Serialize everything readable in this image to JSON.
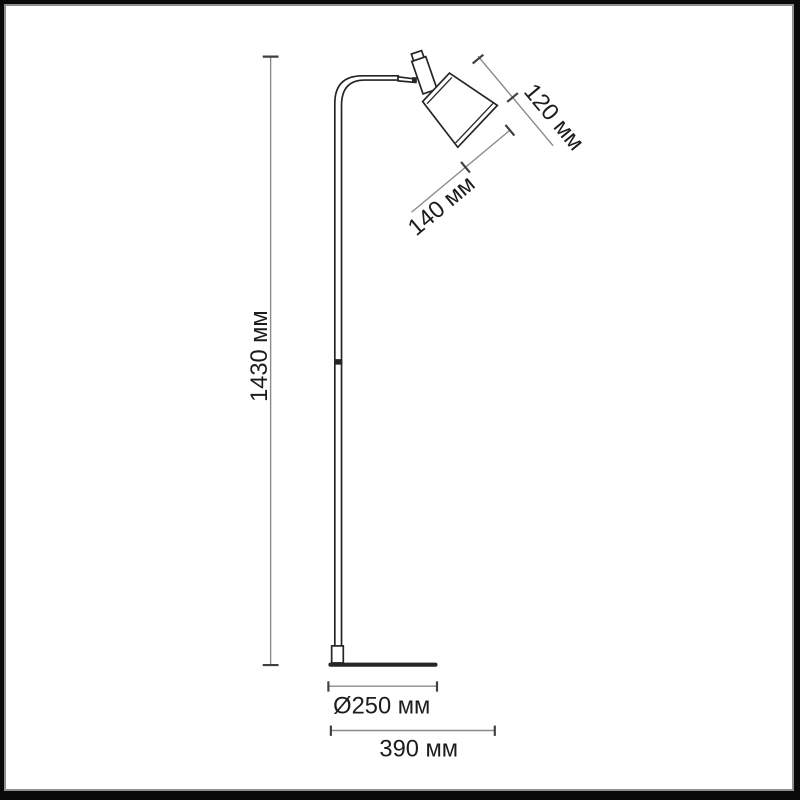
{
  "diagram": {
    "type": "product-dimension-drawing",
    "product": "floor lamp",
    "unit": "мм"
  },
  "labels": {
    "height": "1430 мм",
    "shade_depth": "120 мм",
    "shade_diameter": "140 мм",
    "base_diameter": "Ø250 мм",
    "total_depth": "390 мм"
  },
  "values": {
    "height_mm": 1430,
    "shade_depth_mm": 120,
    "shade_diameter_mm": 140,
    "base_diameter_mm": 250,
    "total_depth_mm": 390
  },
  "colors": {
    "background": "#ffffff",
    "frame_border": "#0a0a0a",
    "frame_inner_line": "#8f8f8f",
    "lamp_outline": "#242424",
    "dimension_line": "#8a8a8a",
    "dimension_tick": "#3f3f3f",
    "label_text": "#1c1c1c"
  }
}
